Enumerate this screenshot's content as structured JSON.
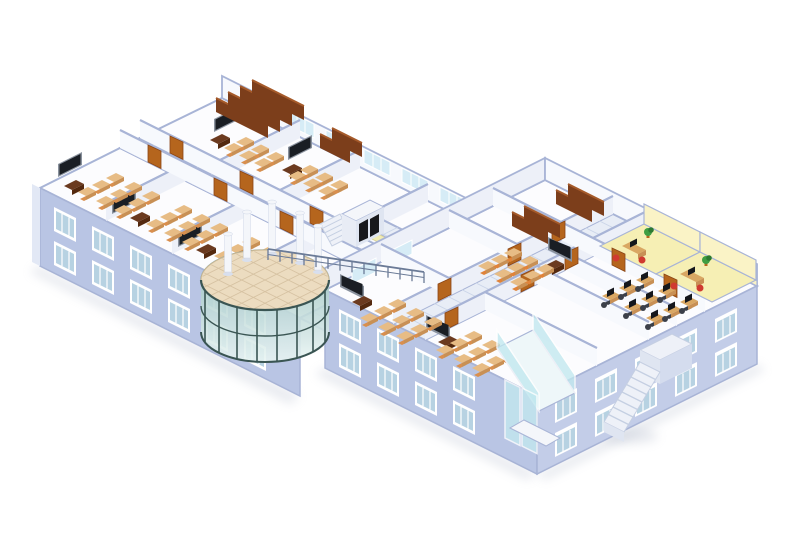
{
  "meta": {
    "view": "isometric-cutaway-building",
    "background": "#ffffff"
  },
  "palette": {
    "bg": "#ffffff",
    "wall_front": "#b9c5e4",
    "wall_front2": "#c3cde8",
    "wall_gable": "#e2e8f5",
    "wall_cap": "#a8b4d6",
    "wall_int_sw": "#f7f9fd",
    "wall_int_se": "#edf0f8",
    "floor_room": "#fcfcfe",
    "floor_corr": "#e8edf6",
    "floor_grid": "#c9d4e8",
    "floor_atrium": "#ecdcc0",
    "atrium_grid": "#d6c2a2",
    "atrium_edge": "#cbb894",
    "window_frame": "#ffffff",
    "window_glass": "#b7d2e2",
    "glass_back": "#d6ecf6",
    "glass_cyan": "#c2e8ef",
    "vestibule_floor": "#eef7f9",
    "glass_atrium_1": "#a9cbc9",
    "glass_atrium_2": "#e9f5f3",
    "mullion": "#3a5553",
    "mullion_light": "#86a3a1",
    "desk_top": "#e7bc85",
    "desk_side": "#c89055",
    "chair": "#d98f4e",
    "chair_orange": "#e0833a",
    "chair_red": "#d03a30",
    "chair_office": "#3c4049",
    "teacher_desk": "#6b3a1f",
    "teacher_desk_side": "#54290f",
    "board": "#1a1e24",
    "board_frame": "#8a929e",
    "door": "#b5651d",
    "door_dark": "#8a4516",
    "shelf": "#7c3e1b",
    "shelf_top": "#a55a2a",
    "lab_desk": "#d9a763",
    "monitor": "#15171c",
    "yellow_wall": "#faf3c6",
    "yellow_floor": "#f6efb4",
    "plant": "#3f9e42",
    "plant_dark": "#2d7a31",
    "pot": "#b5651d",
    "column": "#f4f6fa",
    "column_shade": "#d8dfee",
    "shadow": "#aab3c6",
    "stair": "#eef1f8",
    "stair_line": "#c5cfe2",
    "railing": "#6b7b97",
    "mat": "#f2edb4",
    "mat_edge": "#d8d29a",
    "elevator_door": "#17181c"
  },
  "scene": {
    "rooms": [
      {
        "id": "classroom-west-1",
        "type": "classroom"
      },
      {
        "id": "classroom-west-2",
        "type": "classroom"
      },
      {
        "id": "classroom-west-3",
        "type": "classroom"
      },
      {
        "id": "reading-room",
        "type": "library"
      },
      {
        "id": "study-room-1",
        "type": "classroom-small"
      },
      {
        "id": "study-room-2",
        "type": "classroom-small"
      },
      {
        "id": "shelf-room-west",
        "type": "book-storage"
      },
      {
        "id": "lecture-room-east",
        "type": "classroom"
      },
      {
        "id": "book-stacks-1",
        "type": "book-storage"
      },
      {
        "id": "book-stacks-2",
        "type": "book-storage"
      },
      {
        "id": "classroom-south-1",
        "type": "classroom"
      },
      {
        "id": "classroom-south-2",
        "type": "classroom"
      },
      {
        "id": "computer-lab",
        "type": "computer-lab"
      },
      {
        "id": "office-yellow-1",
        "type": "office"
      },
      {
        "id": "office-yellow-2",
        "type": "office"
      },
      {
        "id": "glass-rotunda-lobby",
        "type": "atrium"
      },
      {
        "id": "bridge-corridor",
        "type": "corridor"
      },
      {
        "id": "elevator-core",
        "type": "elevator"
      },
      {
        "id": "entrance-vestibule",
        "type": "entrance"
      },
      {
        "id": "external-staircase",
        "type": "stairs"
      }
    ],
    "w1_windows": [
      [
        54,
        207
      ],
      [
        92,
        226
      ],
      [
        130,
        245
      ],
      [
        168,
        264
      ],
      [
        206,
        283
      ],
      [
        244,
        302
      ],
      [
        54,
        241
      ],
      [
        92,
        260
      ],
      [
        130,
        279
      ],
      [
        168,
        298
      ],
      [
        206,
        317
      ],
      [
        244,
        336
      ]
    ],
    "w2fl_windows": [
      [
        339,
        309
      ],
      [
        377,
        328
      ],
      [
        415,
        347
      ],
      [
        453,
        366
      ],
      [
        339,
        343
      ],
      [
        377,
        362
      ],
      [
        415,
        381
      ],
      [
        453,
        400
      ]
    ],
    "w2fr_windows": [
      [
        555,
        399
      ],
      [
        595,
        379
      ],
      [
        635,
        359
      ],
      [
        675,
        339
      ],
      [
        715,
        319
      ],
      [
        555,
        433
      ],
      [
        595,
        413
      ],
      [
        635,
        393
      ],
      [
        675,
        373
      ],
      [
        715,
        353
      ]
    ],
    "w1_back_windows": [
      [
        250,
        106
      ],
      [
        288,
        125
      ],
      [
        326,
        144
      ],
      [
        364,
        163
      ],
      [
        402,
        182
      ],
      [
        440,
        201
      ]
    ],
    "w2_nw_windows": [
      [
        352,
        270
      ],
      [
        388,
        252
      ]
    ],
    "w1_walls_u": [
      [
        106,
        221,
        80
      ],
      [
        172,
        254,
        80
      ],
      [
        238,
        287,
        80
      ],
      [
        220,
        178,
        80
      ],
      [
        280,
        208,
        80
      ],
      [
        348,
        242,
        80
      ]
    ],
    "w1_walls_v": [
      [
        120,
        148,
        260
      ],
      [
        140,
        138,
        260
      ]
    ],
    "w2_walls_u": [
      [
        393,
        324,
        220
      ],
      [
        425,
        340,
        220
      ],
      [
        629,
        274,
        44
      ]
    ],
    "w2_walls_v": [
      [
        381,
        262,
        68
      ],
      [
        449,
        228,
        68
      ],
      [
        485,
        310,
        112
      ],
      [
        537,
        284,
        112
      ],
      [
        565,
        270,
        112
      ],
      [
        493,
        206,
        212
      ]
    ],
    "doors_a": [
      [
        148,
        162
      ],
      [
        214,
        195
      ],
      [
        280,
        228
      ],
      [
        170,
        153
      ],
      [
        240,
        188
      ],
      [
        310,
        223
      ],
      [
        612,
        265
      ],
      [
        664,
        291
      ]
    ],
    "doors_b": [
      [
        438,
        301
      ],
      [
        508,
        266
      ],
      [
        552,
        244
      ],
      [
        445,
        330
      ],
      [
        521,
        292
      ],
      [
        565,
        270
      ]
    ],
    "boards_se": [
      [
        58,
        177
      ],
      [
        112,
        214
      ],
      [
        178,
        247
      ],
      [
        214,
        132
      ],
      [
        288,
        160
      ]
    ],
    "boards_sw": [
      [
        548,
        250
      ],
      [
        340,
        287
      ],
      [
        426,
        328
      ]
    ],
    "teacher_desks": [
      [
        64,
        186
      ],
      [
        130,
        218
      ],
      [
        196,
        250
      ],
      [
        210,
        140
      ],
      [
        282,
        170
      ],
      [
        544,
        266
      ],
      [
        352,
        302
      ],
      [
        438,
        342
      ]
    ],
    "desk_clusters": [
      {
        "x": 78,
        "y": 192,
        "rows": 3,
        "cols": 3,
        "du": [
          14,
          -7
        ],
        "dv": [
          18,
          9
        ],
        "style": "classroom"
      },
      {
        "x": 146,
        "y": 224,
        "rows": 3,
        "cols": 3,
        "du": [
          14,
          -7
        ],
        "dv": [
          18,
          9
        ],
        "style": "classroom"
      },
      {
        "x": 214,
        "y": 256,
        "rows": 3,
        "cols": 3,
        "du": [
          14,
          -7
        ],
        "dv": [
          18,
          9
        ],
        "style": "classroom"
      },
      {
        "x": 224,
        "y": 148,
        "rows": 2,
        "cols": 3,
        "du": [
          12,
          -6
        ],
        "dv": [
          15,
          7.5
        ],
        "style": "classroom"
      },
      {
        "x": 288,
        "y": 176,
        "rows": 2,
        "cols": 3,
        "du": [
          12,
          -6
        ],
        "dv": [
          15,
          7.5
        ],
        "style": "classroom"
      },
      {
        "x": 478,
        "y": 266,
        "rows": 3,
        "cols": 3,
        "du": [
          13,
          -6.5
        ],
        "dv": [
          16,
          8
        ],
        "style": "orange"
      },
      {
        "x": 360,
        "y": 318,
        "rows": 3,
        "cols": 3,
        "du": [
          14,
          -7
        ],
        "dv": [
          18,
          9
        ],
        "style": "classroom"
      },
      {
        "x": 436,
        "y": 350,
        "rows": 3,
        "cols": 3,
        "du": [
          14,
          -7
        ],
        "dv": [
          18,
          9
        ],
        "style": "classroom"
      },
      {
        "x": 602,
        "y": 296,
        "rows": 3,
        "cols": 3,
        "du": [
          17,
          -8
        ],
        "dv": [
          22,
          11
        ],
        "style": "lab"
      }
    ],
    "shelves": [
      {
        "x": 216,
        "y": 112,
        "count": 4,
        "len": 52
      },
      {
        "x": 320,
        "y": 148,
        "count": 2,
        "len": 30
      },
      {
        "x": 512,
        "y": 226,
        "count": 2,
        "len": 36
      },
      {
        "x": 556,
        "y": 204,
        "count": 2,
        "len": 36
      }
    ],
    "offices": [
      {
        "desk": [
          622,
          246
        ],
        "monitor": [
          630,
          242
        ],
        "chairs": [
          [
            616,
            258
          ],
          [
            642,
            260
          ]
        ],
        "plant": [
          648,
          232
        ]
      },
      {
        "desk": [
          680,
          274
        ],
        "monitor": [
          688,
          270
        ],
        "chairs": [
          [
            674,
            286
          ],
          [
            700,
            288
          ]
        ],
        "plant": [
          706,
          260
        ]
      }
    ],
    "atrium": {
      "cx": 265,
      "cy": 280,
      "rx": 64,
      "ry": 30,
      "drop": 52,
      "mullions": [
        205,
        219,
        237,
        257,
        277,
        297,
        313,
        325
      ],
      "columns": [
        [
          247,
          258,
          46
        ],
        [
          272,
          252,
          50
        ],
        [
          300,
          261,
          48
        ],
        [
          318,
          270,
          44
        ],
        [
          228,
          272,
          38
        ]
      ]
    },
    "railing": {
      "x0": 268,
      "y0": 260,
      "x1": 424,
      "y1": 283,
      "posts": 14,
      "post_h": 11
    },
    "stairs_ext": {
      "steps": 7
    },
    "stairs_int": {
      "steps": 4
    },
    "mats": [
      [
        366,
        236
      ],
      [
        381,
        243
      ]
    ],
    "grids": [
      {
        "g": "w1-grid",
        "a": [
          120,
          148
        ],
        "l": [
          260,
          130
        ],
        "w": [
          20,
          -10
        ],
        "n": 18
      },
      {
        "g": "w1-grid",
        "a": [
          300,
          318
        ],
        "l": [
          100,
          -50
        ],
        "w": [
          45,
          23
        ],
        "n": 8
      },
      {
        "g": "w2-grid",
        "a": [
          393,
          324
        ],
        "l": [
          220,
          -110
        ],
        "w": [
          32,
          16
        ],
        "n": 16
      },
      {
        "g": "core-grid",
        "a": [
          343,
          228
        ],
        "l": [
          80,
          40
        ],
        "w": [
          28,
          -14
        ],
        "n": 6
      }
    ]
  }
}
